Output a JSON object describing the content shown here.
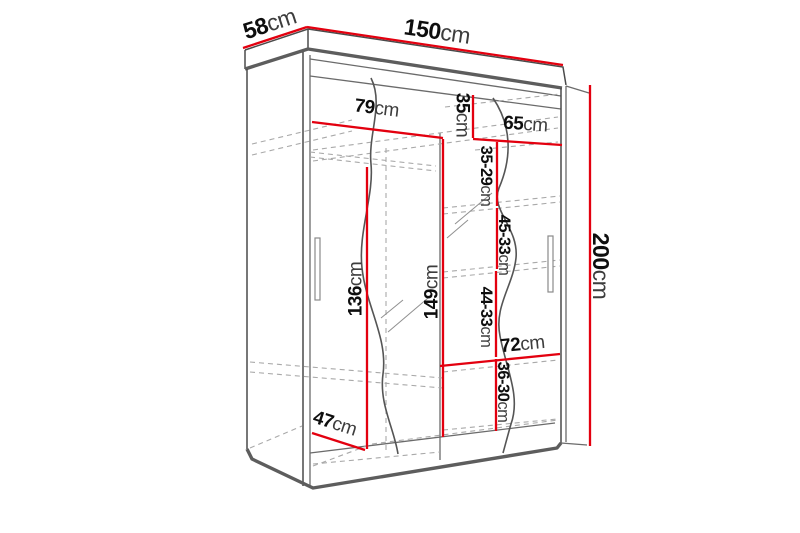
{
  "diagram": {
    "type": "wardrobe-dimension-drawing",
    "background": "#ffffff",
    "colors": {
      "dimension_line": "#e3000f",
      "outline": "#4a4a4a",
      "hidden_edge_dashed": "#a9a9a9",
      "label_number": "#0e0e0e",
      "label_unit": "#3d3d3d"
    },
    "overall_dimensions": {
      "width": {
        "num": "150",
        "unit": "cm"
      },
      "depth": {
        "num": "58",
        "unit": "cm"
      },
      "height": {
        "num": "200",
        "unit": "cm"
      }
    },
    "interior_dimensions": {
      "left_shelf_width": {
        "num": "79",
        "unit": "cm"
      },
      "top_right_gap": {
        "num": "35",
        "unit": "cm"
      },
      "right_shelf_width": {
        "num": "65",
        "unit": "cm"
      },
      "right_gap_1": {
        "num": "35-29",
        "unit": "cm"
      },
      "right_gap_2": {
        "num": "45-33",
        "unit": "cm"
      },
      "left_column_height": {
        "num": "136",
        "unit": "cm"
      },
      "center_column_height": {
        "num": "149",
        "unit": "cm"
      },
      "right_gap_3": {
        "num": "44-33",
        "unit": "cm"
      },
      "bottom_right_shelf_width": {
        "num": "72",
        "unit": "cm"
      },
      "right_gap_4": {
        "num": "36-30",
        "unit": "cm"
      },
      "bottom_depth": {
        "num": "47",
        "unit": "cm"
      }
    }
  }
}
